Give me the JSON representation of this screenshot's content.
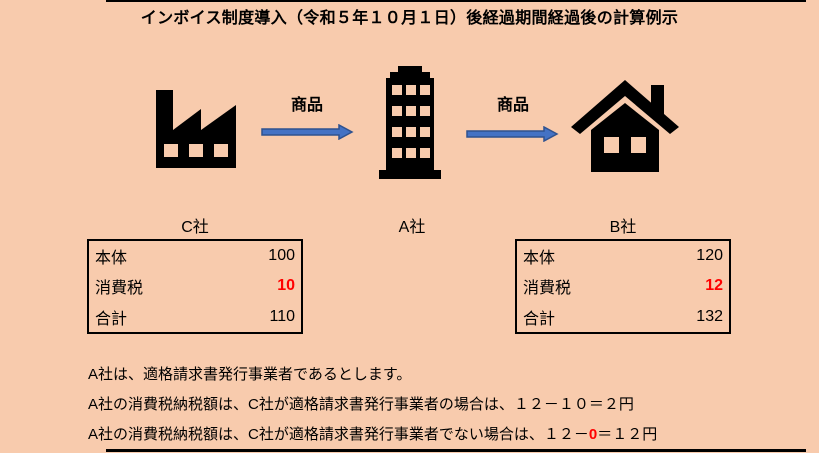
{
  "title": "インボイス制度導入（令和５年１０月１日）後経過期間経過後の計算例示",
  "flow": {
    "goods_label_1": "商品",
    "goods_label_2": "商品",
    "companies": {
      "c": "C社",
      "a": "A社",
      "b": "B社"
    },
    "icons": {
      "seller": "factory-icon",
      "middle": "office-building-icon",
      "buyer": "house-icon",
      "connector": "right-arrow-icon"
    }
  },
  "tables": {
    "c": {
      "rows": [
        {
          "label": "本体",
          "value": "100"
        },
        {
          "label": "消費税",
          "value": "10",
          "highlight": true
        },
        {
          "label": "合計",
          "value": "110"
        }
      ]
    },
    "b": {
      "rows": [
        {
          "label": "本体",
          "value": "120"
        },
        {
          "label": "消費税",
          "value": "12",
          "highlight": true
        },
        {
          "label": "合計",
          "value": "132"
        }
      ]
    }
  },
  "notes": {
    "line1": "A社は、適格請求書発行事業者であるとします。",
    "line2": "A社の消費税納税額は、C社が適格請求書発行事業者の場合は、１２－１０＝２円",
    "line3_prefix": "A社の消費税納税額は、C社が適格請求書発行事業者でない場合は、１２－",
    "line3_highlight": "0",
    "line3_suffix": "＝１２円"
  },
  "colors": {
    "background": "#F8CBAD",
    "text": "#000000",
    "highlight": "#FF0000",
    "arrow_fill": "#4472C4",
    "arrow_outline": "#2F528F"
  }
}
